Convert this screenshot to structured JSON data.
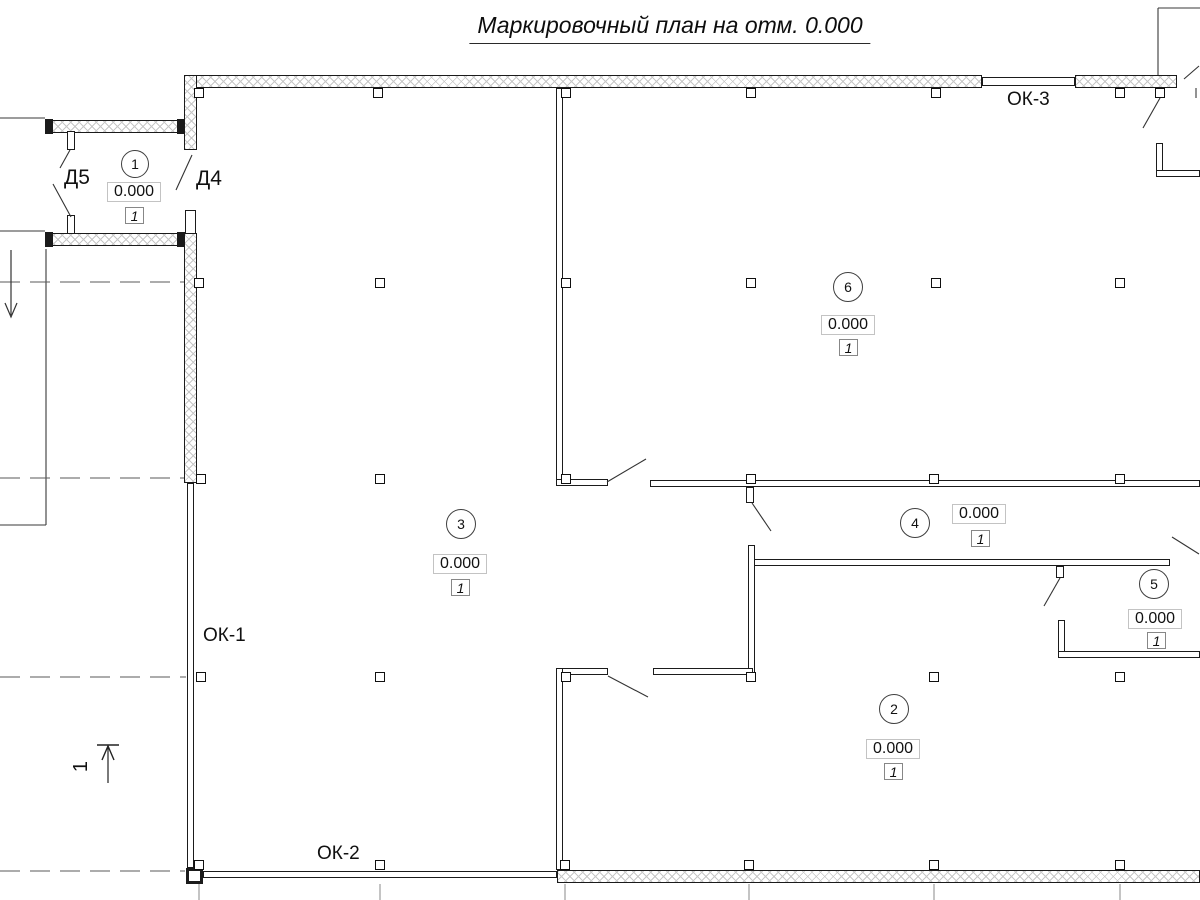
{
  "title": "Маркировочный план на отм. 0.000",
  "colors": {
    "line": "#1b1b1b",
    "hatch": "#c7c7c7",
    "thin_line": "#3a3a3a",
    "dashed_line": "#5a5a5a",
    "grid_line": "#8a8a8a",
    "background": "#ffffff"
  },
  "room_markers": [
    {
      "number": "1",
      "elevation": "0.000",
      "finish_type": "1",
      "circle": {
        "cx": 135,
        "cy": 164,
        "r": 14
      },
      "elev_box": {
        "x": 107,
        "y": 182,
        "w": 54,
        "h": 20
      },
      "fin_box": {
        "x": 125,
        "y": 207,
        "w": 19,
        "h": 17
      }
    },
    {
      "number": "2",
      "elevation": "0.000",
      "finish_type": "1",
      "circle": {
        "cx": 894,
        "cy": 709,
        "r": 15
      },
      "elev_box": {
        "x": 866,
        "y": 739,
        "w": 54,
        "h": 20
      },
      "fin_box": {
        "x": 884,
        "y": 763,
        "w": 19,
        "h": 17
      }
    },
    {
      "number": "3",
      "elevation": "0.000",
      "finish_type": "1",
      "circle": {
        "cx": 461,
        "cy": 524,
        "r": 15
      },
      "elev_box": {
        "x": 433,
        "y": 554,
        "w": 54,
        "h": 20
      },
      "fin_box": {
        "x": 451,
        "y": 579,
        "w": 19,
        "h": 17
      }
    },
    {
      "number": "4",
      "elevation": "0.000",
      "finish_type": "1",
      "circle": {
        "cx": 915,
        "cy": 523,
        "r": 15
      },
      "elev_box": {
        "x": 952,
        "y": 504,
        "w": 54,
        "h": 20
      },
      "fin_box": {
        "x": 971,
        "y": 530,
        "w": 19,
        "h": 17
      }
    },
    {
      "number": "5",
      "elevation": "0.000",
      "finish_type": "1",
      "circle": {
        "cx": 1154,
        "cy": 584,
        "r": 15
      },
      "elev_box": {
        "x": 1128,
        "y": 609,
        "w": 54,
        "h": 20
      },
      "fin_box": {
        "x": 1147,
        "y": 632,
        "w": 19,
        "h": 17
      }
    },
    {
      "number": "6",
      "elevation": "0.000",
      "finish_type": "1",
      "circle": {
        "cx": 848,
        "cy": 287,
        "r": 15
      },
      "elev_box": {
        "x": 821,
        "y": 315,
        "w": 54,
        "h": 20
      },
      "fin_box": {
        "x": 839,
        "y": 339,
        "w": 19,
        "h": 17
      }
    }
  ],
  "window_labels": [
    {
      "text": "ОК-1",
      "x": 203,
      "y": 626,
      "size": 19
    },
    {
      "text": "ОК-2",
      "x": 317,
      "y": 844,
      "size": 19
    },
    {
      "text": "ОК-3",
      "x": 1007,
      "y": 90,
      "size": 19
    }
  ],
  "door_labels": [
    {
      "text": "Д5",
      "x": 64,
      "y": 167,
      "size": 21
    },
    {
      "text": "Д4",
      "x": 196,
      "y": 168,
      "size": 21
    }
  ],
  "section_mark": {
    "label": "1",
    "tick": [
      97,
      745,
      119,
      745
    ],
    "shaft": [
      108,
      746,
      108,
      783
    ],
    "head": [
      [
        102,
        760
      ],
      [
        108,
        746
      ],
      [
        114,
        760
      ]
    ]
  },
  "down_arrow": {
    "shaft": [
      11,
      250,
      11,
      315
    ],
    "head": [
      [
        5,
        303
      ],
      [
        11,
        317
      ],
      [
        17,
        303
      ]
    ]
  },
  "geometry": {
    "hatched_walls": [
      {
        "x": 185,
        "y": 75,
        "w": 797,
        "h": 13
      },
      {
        "x": 1075,
        "y": 75,
        "w": 102,
        "h": 13
      },
      {
        "x": 184,
        "y": 75,
        "w": 13,
        "h": 75
      },
      {
        "x": 184,
        "y": 233,
        "w": 13,
        "h": 250
      },
      {
        "x": 45,
        "y": 120,
        "w": 140,
        "h": 13
      },
      {
        "x": 45,
        "y": 233,
        "w": 140,
        "h": 13
      },
      {
        "x": 557,
        "y": 870,
        "w": 643,
        "h": 13
      }
    ],
    "thin_walls": [
      {
        "x": 982,
        "y": 77,
        "w": 93,
        "h": 9
      },
      {
        "x": 187,
        "y": 483,
        "w": 7,
        "h": 385
      },
      {
        "x": 203,
        "y": 871,
        "w": 354,
        "h": 7
      },
      {
        "x": 185,
        "y": 210,
        "w": 11,
        "h": 24
      },
      {
        "x": 556,
        "y": 88,
        "w": 7,
        "h": 395
      },
      {
        "x": 556,
        "y": 479,
        "w": 52,
        "h": 7
      },
      {
        "x": 650,
        "y": 480,
        "w": 550,
        "h": 7
      },
      {
        "x": 748,
        "y": 559,
        "w": 422,
        "h": 7
      },
      {
        "x": 748,
        "y": 545,
        "w": 7,
        "h": 130
      },
      {
        "x": 556,
        "y": 668,
        "w": 52,
        "h": 7
      },
      {
        "x": 653,
        "y": 668,
        "w": 100,
        "h": 7
      },
      {
        "x": 556,
        "y": 668,
        "w": 7,
        "h": 202
      },
      {
        "x": 1058,
        "y": 620,
        "w": 7,
        "h": 38
      },
      {
        "x": 1058,
        "y": 651,
        "w": 142,
        "h": 7
      },
      {
        "x": 1156,
        "y": 143,
        "w": 7,
        "h": 34
      },
      {
        "x": 1156,
        "y": 170,
        "w": 44,
        "h": 7
      },
      {
        "x": 67,
        "y": 131,
        "w": 8,
        "h": 19
      },
      {
        "x": 67,
        "y": 215,
        "w": 8,
        "h": 19
      },
      {
        "x": 746,
        "y": 487,
        "w": 8,
        "h": 16
      },
      {
        "x": 1056,
        "y": 566,
        "w": 8,
        "h": 12
      }
    ],
    "solid_blocks": [
      {
        "x": 45,
        "y": 119,
        "w": 8,
        "h": 15
      },
      {
        "x": 177,
        "y": 119,
        "w": 8,
        "h": 15
      },
      {
        "x": 45,
        "y": 232,
        "w": 8,
        "h": 15
      },
      {
        "x": 177,
        "y": 232,
        "w": 8,
        "h": 15
      }
    ],
    "corner_blocks": [
      {
        "x": 186,
        "y": 868,
        "w": 17,
        "h": 16
      }
    ],
    "squares": [
      [
        199,
        93
      ],
      [
        378,
        93
      ],
      [
        566,
        93
      ],
      [
        751,
        93
      ],
      [
        936,
        93
      ],
      [
        1120,
        93
      ],
      [
        1160,
        93
      ],
      [
        199,
        283
      ],
      [
        380,
        283
      ],
      [
        566,
        283
      ],
      [
        751,
        283
      ],
      [
        936,
        283
      ],
      [
        1120,
        283
      ],
      [
        201,
        479
      ],
      [
        380,
        479
      ],
      [
        566,
        479
      ],
      [
        751,
        479
      ],
      [
        934,
        479
      ],
      [
        1120,
        479
      ],
      [
        201,
        677
      ],
      [
        380,
        677
      ],
      [
        566,
        677
      ],
      [
        751,
        677
      ],
      [
        934,
        677
      ],
      [
        1120,
        677
      ],
      [
        199,
        865
      ],
      [
        380,
        865
      ],
      [
        565,
        865
      ],
      [
        749,
        865
      ],
      [
        934,
        865
      ],
      [
        1120,
        865
      ]
    ],
    "solid_lines": [
      [
        0,
        118,
        45,
        118
      ],
      [
        0,
        231,
        45,
        231
      ],
      [
        46,
        249,
        46,
        525
      ],
      [
        0,
        525,
        46,
        525
      ],
      [
        1158,
        8,
        1158,
        75
      ],
      [
        1158,
        8,
        1200,
        8
      ],
      [
        1196,
        88,
        1196,
        98
      ]
    ],
    "grid_lines": [
      [
        199,
        884,
        199,
        900
      ],
      [
        380,
        884,
        380,
        900
      ],
      [
        565,
        884,
        565,
        900
      ],
      [
        749,
        884,
        749,
        900
      ],
      [
        934,
        884,
        934,
        900
      ],
      [
        1120,
        884,
        1120,
        900
      ]
    ],
    "dashed_lines": [
      [
        0,
        282,
        184,
        282
      ],
      [
        0,
        478,
        184,
        478
      ],
      [
        0,
        677,
        186,
        677
      ],
      [
        0,
        871,
        185,
        871
      ]
    ],
    "door_swings": [
      [
        70,
        150,
        60,
        168
      ],
      [
        53,
        184,
        71,
        217
      ],
      [
        192,
        155,
        176,
        190
      ],
      [
        607,
        482,
        646,
        459
      ],
      [
        608,
        676,
        648,
        697
      ],
      [
        752,
        503,
        771,
        531
      ],
      [
        1060,
        578,
        1044,
        606
      ],
      [
        1160,
        98,
        1143,
        128
      ],
      [
        1172,
        537,
        1199,
        554
      ],
      [
        1184,
        79,
        1199,
        66
      ]
    ]
  }
}
